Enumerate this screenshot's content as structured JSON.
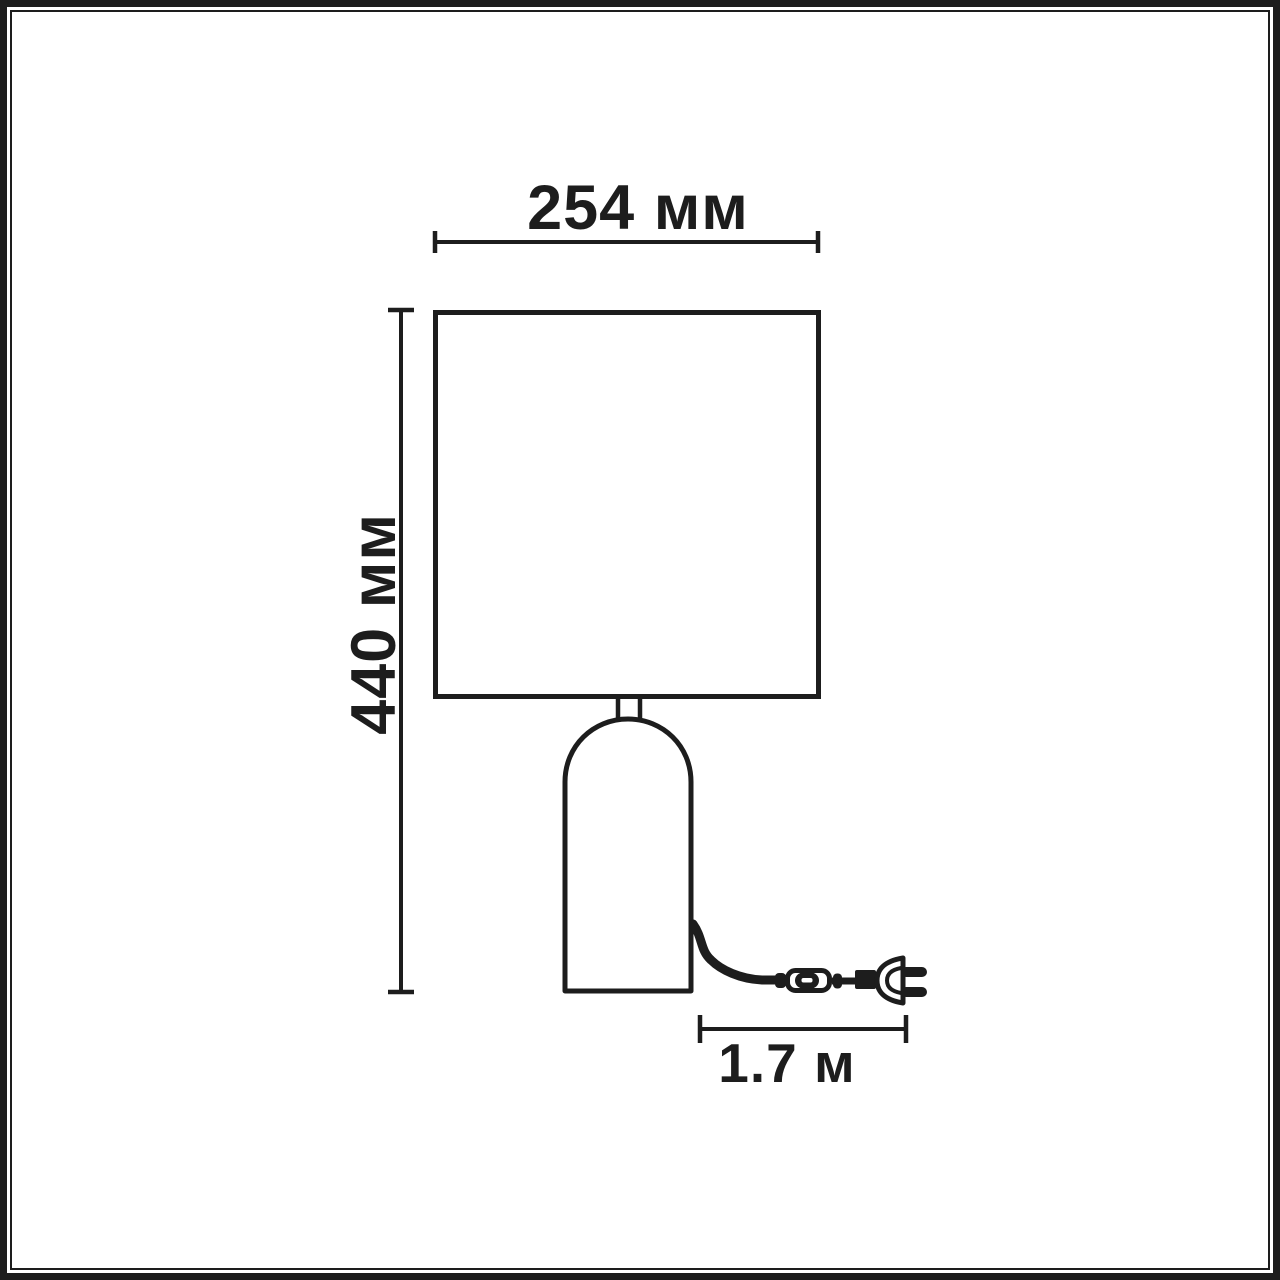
{
  "diagram": {
    "subject": "table-lamp-dimension-drawing",
    "labels": {
      "shade_width": "254 мм",
      "lamp_height": "440 мм",
      "cord_length": "1.7 м"
    },
    "colors": {
      "line": "#1d1d1d",
      "background": "#ffffff"
    }
  }
}
